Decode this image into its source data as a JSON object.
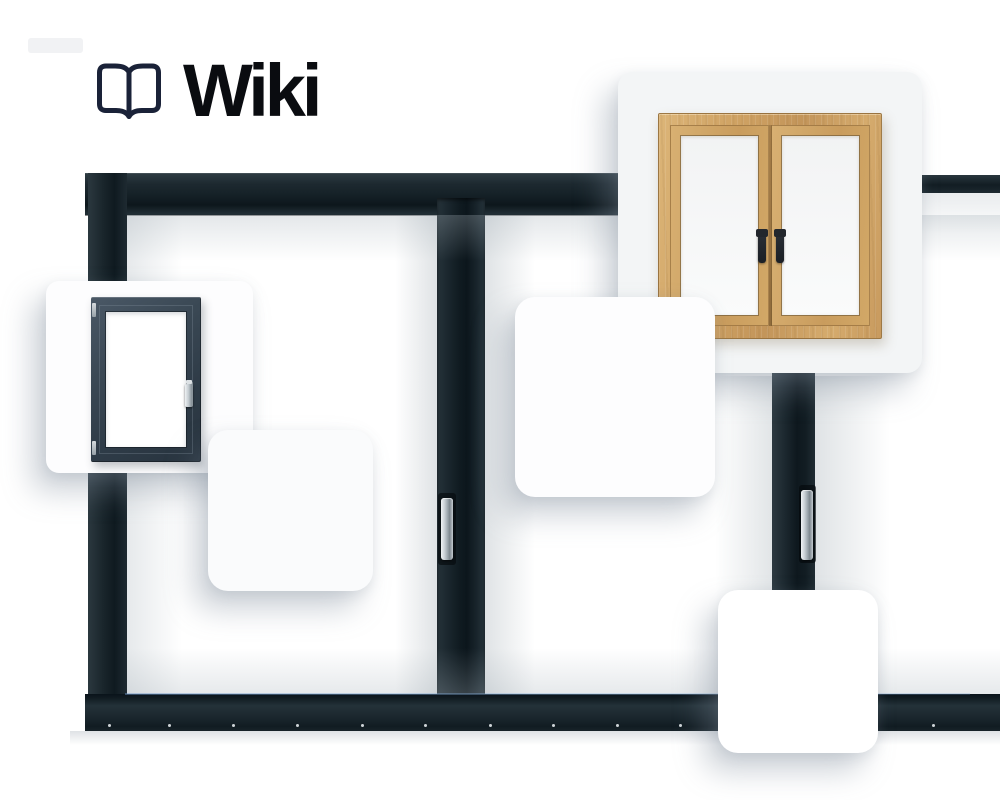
{
  "header": {
    "title": "Wiki",
    "logo_icon": "open-book-icon",
    "title_color": "#0a0c10",
    "logo_color": "#1a2238"
  },
  "hero": {
    "name": "window-product-collage",
    "frame_color_dark": "#0d171c",
    "frame_color_mid": "#1d2930",
    "glass_color": "#ffffff",
    "chrome_handle_color": "#c3cad0",
    "sill_screw_count": 11
  },
  "cards": {
    "anthracite_window": {
      "content": "anthracite-single-window-photo",
      "frame_color": "#36434e",
      "background": "#fdfdfe"
    },
    "wooden_window": {
      "content": "wooden-double-casement-window-photo",
      "wood_color": "#cfa263",
      "handle_color": "#23272d",
      "background": "#f3f5f6"
    },
    "blank_count": 3,
    "blank_background": "#ffffff"
  }
}
